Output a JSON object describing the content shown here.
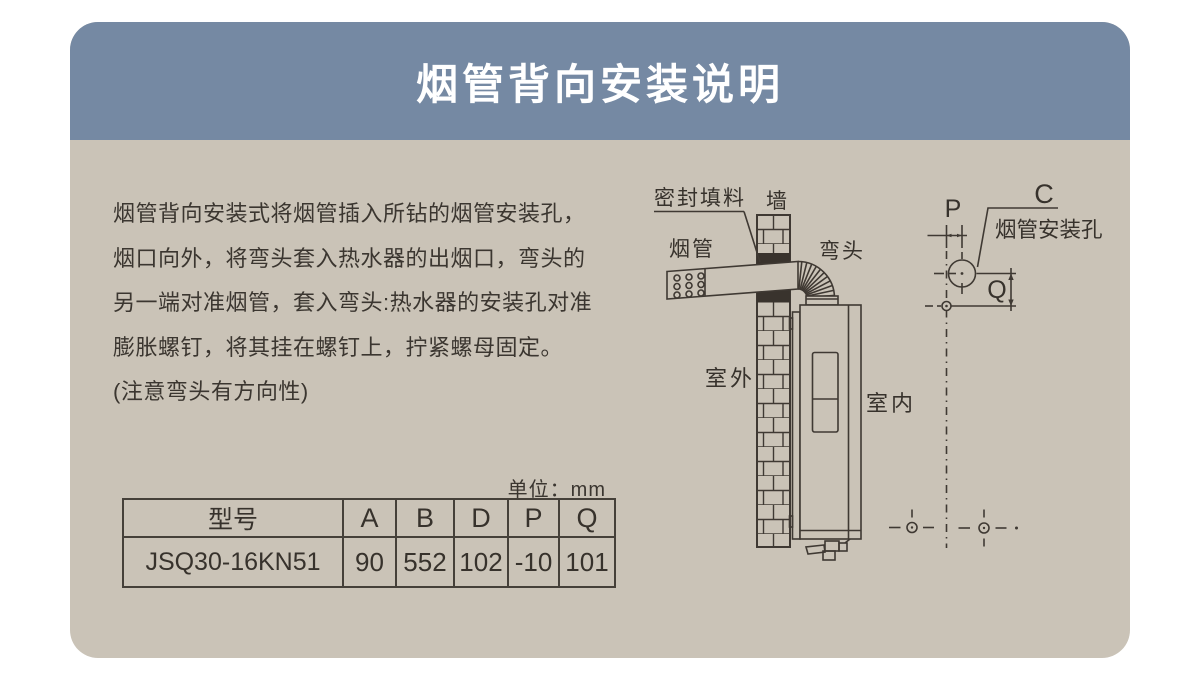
{
  "window": {
    "title": "烟管背向安装说明"
  },
  "colors": {
    "header_bg": "#7589A3",
    "body_bg": "#CAC3B7",
    "line": "#3F3933",
    "title_text": "#FFFFFF",
    "text": "#3B3630"
  },
  "instructions": {
    "lines": [
      "烟管背向安装式将烟管插入所钻的烟管安装孔，",
      "烟口向外，将弯头套入热水器的出烟口，弯头的",
      "另一端对准烟管，套入弯头:热水器的安装孔对准",
      "膨胀螺钉，将其挂在螺钉上，拧紧螺母固定。",
      "(注意弯头有方向性)"
    ]
  },
  "spec_table": {
    "unit_label": "单位：mm",
    "headers": [
      "型号",
      "A",
      "B",
      "D",
      "P",
      "Q"
    ],
    "rows": [
      [
        "JSQ30-16KN51",
        "90",
        "552",
        "102",
        "-10",
        "101"
      ]
    ]
  },
  "diagram": {
    "labels": {
      "sealing": "密封填料",
      "wall": "墙",
      "flue_pipe": "烟管",
      "elbow": "弯头",
      "outdoor": "室外",
      "indoor": "室内",
      "install_hole": "烟管安装孔",
      "dim_p": "P",
      "dim_c": "C",
      "dim_q": "Q"
    }
  }
}
